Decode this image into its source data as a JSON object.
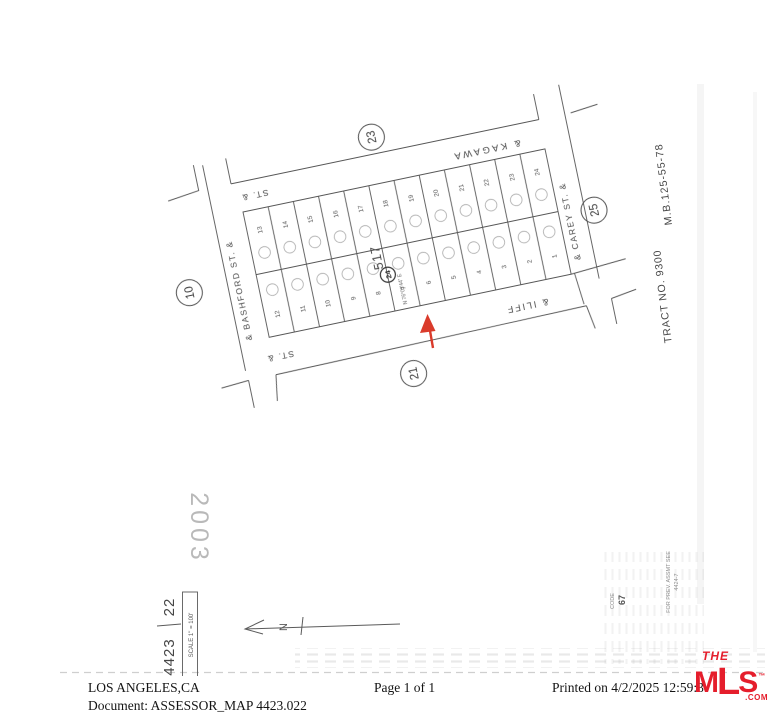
{
  "document": {
    "location": "LOS ANGELES,CA",
    "doc_label": "Document: ASSESSOR_MAP 4423.022",
    "page_info": "Page 1 of 1",
    "printed": "Printed on 4/2/2025 12:59:3"
  },
  "logo": {
    "the": "THE",
    "mls_m": "M",
    "mls_l": "L",
    "mls_s": "S",
    "tm": "™",
    "com": ".COM",
    "color": "#e51e2c"
  },
  "map": {
    "streets": {
      "kagawa": "& KAGAWA",
      "kagawa_st": "ST. &",
      "bashford": "& BASHFORD ST. &",
      "iliff": "& ILIFF",
      "iliff_st": "ST. &",
      "carey": "& CAREY ST. &"
    },
    "circled_refs": {
      "top": "23",
      "left": "10",
      "bottom": "21",
      "right": "25"
    },
    "tract": "TRACT NO. 9300",
    "map_book": "M.B.125-55-78",
    "block_label": "517",
    "block_circle": "24",
    "bearing": "N 76°03'44\" E",
    "lots_top": [
      "13",
      "14",
      "15",
      "16",
      "17",
      "18",
      "19",
      "20",
      "21",
      "22",
      "23",
      "24"
    ],
    "lots_bottom": [
      "12",
      "11",
      "10",
      "9",
      "8",
      "7",
      "6",
      "5",
      "4",
      "3",
      "2",
      "1"
    ],
    "stamp_year": "2003",
    "sheet_book": "4423",
    "sheet_page": "22",
    "scale_note": "SCALE 1\" = 100'",
    "code_label": "CODE",
    "code_value": "67",
    "prev_line1": "FOR PREV. ASSMT SEE",
    "prev_line2": "4424-7",
    "north": "N",
    "ink_color": "#565656",
    "arrow_color": "#da3b2b"
  }
}
